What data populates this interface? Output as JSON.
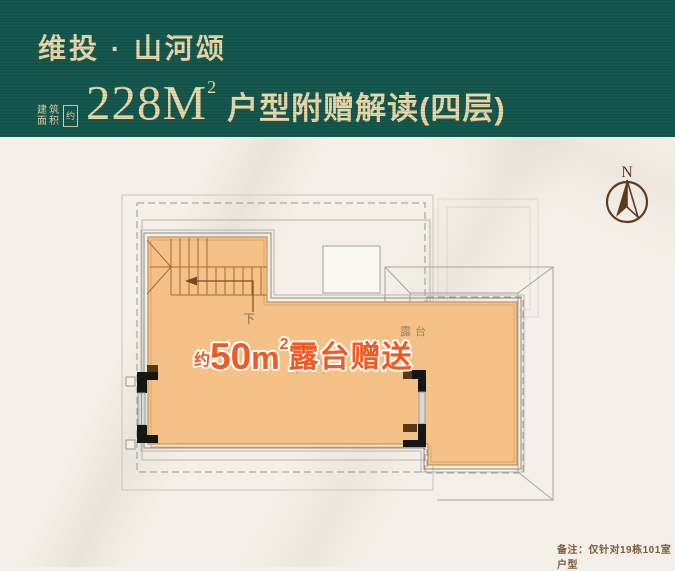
{
  "header": {
    "brand": "维投 · 山河颂",
    "area_seal": {
      "col1_top": "建",
      "col1_bottom": "面",
      "col2_top": "筑",
      "col2_bottom": "积",
      "approx": "约"
    },
    "area_value": "228",
    "area_unit": "M",
    "area_sup": "2",
    "subtitle": "户型附赠解读(四层)"
  },
  "compass": {
    "label": "N"
  },
  "plan": {
    "stairs_down_label": "下",
    "terrace_label": "露台",
    "gift": {
      "approx": "约",
      "value": "50",
      "unit": "m",
      "sup": "2",
      "suffix": "露台赠送"
    }
  },
  "footer": {
    "note": "备注：仅针对19栋101室户型"
  },
  "colors": {
    "header_bg": "#15584e",
    "header_text": "#ead8a8",
    "accent_red": "#f15a22",
    "terrace_fill": "#f5c186",
    "compass_brown": "#5e3a1c"
  }
}
